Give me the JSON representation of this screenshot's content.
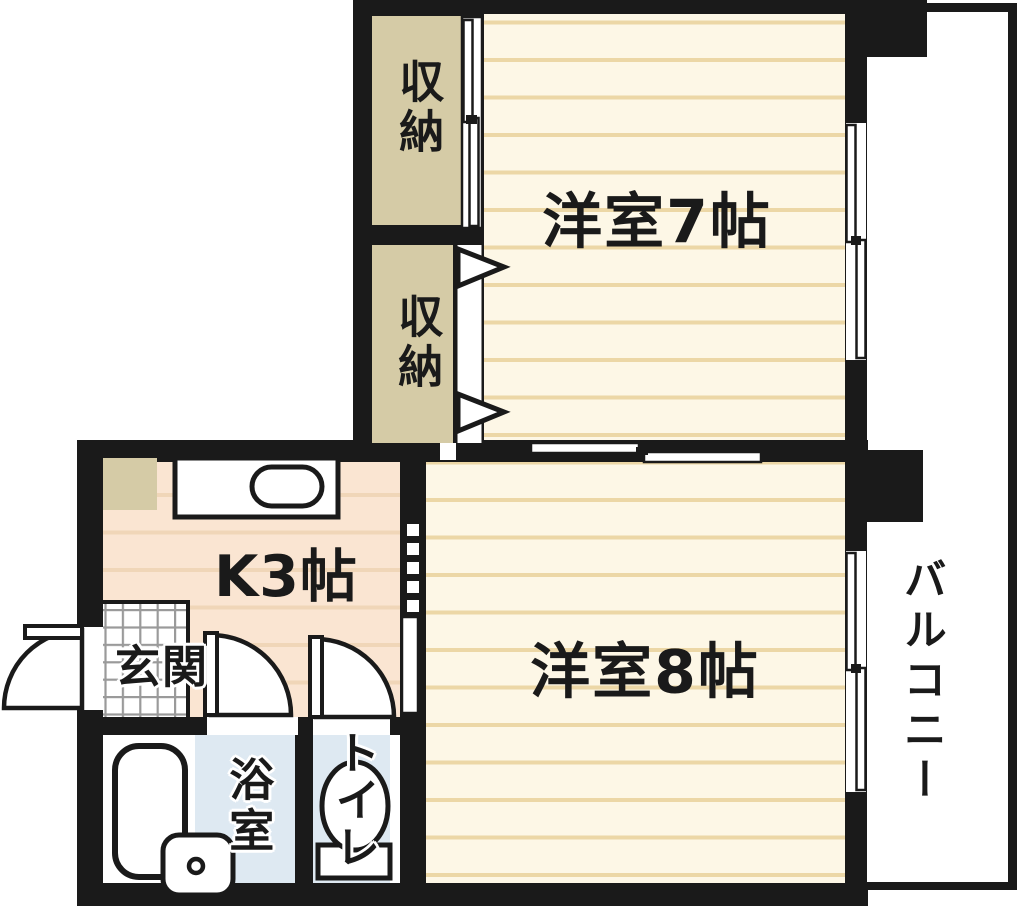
{
  "title": "1DK apartment floor plan",
  "labels": {
    "room7": "洋室7帖",
    "room8": "洋室8帖",
    "kitchen": "K3帖",
    "closet_top": "収納",
    "closet_bottom": "収納",
    "entrance": "玄関",
    "bathroom": "浴室",
    "toilet": "トイレ",
    "balcony": "バルコニー"
  },
  "colors": {
    "wall": "#1a1a1a",
    "room_floor": "#fdf7e6",
    "room_floor_line": "#ecd7a6",
    "kitchen_floor": "#fae5d2",
    "kitchen_floor_line": "#f0d6b8",
    "closet_fill": "#d5cba6",
    "wet_floor": "#dee9f2",
    "tile_line": "#9a9a9a",
    "text": "#1a1a1a",
    "exterior": "#ffffff"
  }
}
